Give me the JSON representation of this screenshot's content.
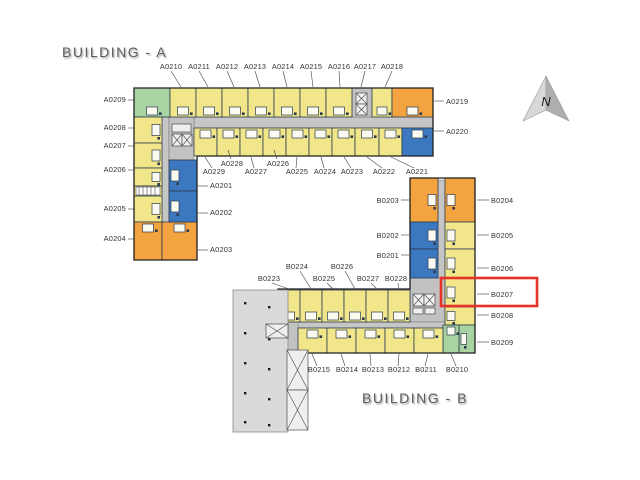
{
  "titles": {
    "building_a": "BUILDING - A",
    "building_b": "BUILDING - B"
  },
  "compass": {
    "label": "N"
  },
  "colors": {
    "yellow": "#f1e78a",
    "orange": "#f3a440",
    "blue": "#3c78c0",
    "green": "#a7d4a2",
    "corridor": "#c6c6c6",
    "core": "#c2c2c2",
    "podium": "#dadada",
    "highlight": "#e53427",
    "line": "#2c3a4e"
  },
  "highlight": {
    "unit": "B0207"
  },
  "building_a": {
    "top_labels": [
      "A0210",
      "A0211",
      "A0212",
      "A0213",
      "A0214",
      "A0215",
      "A0216",
      "A0217",
      "A0218"
    ],
    "left_labels": [
      "A0209",
      "A0208",
      "A0207",
      "A0206",
      "A0205",
      "A0204"
    ],
    "right_end_labels": [
      "A0219",
      "A0220"
    ],
    "inner_labels": [
      "A0201",
      "A0202",
      "A0203"
    ],
    "bottom_upper_labels": [
      "A0228",
      "A0226"
    ],
    "bottom_lower_labels": [
      "A0229",
      "A0227",
      "A0225",
      "A0224",
      "A0223",
      "A0222",
      "A0221"
    ]
  },
  "building_b": {
    "left_labels": [
      "B0203",
      "B0202",
      "B0201"
    ],
    "right_labels": [
      "B0204",
      "B0205",
      "B0206",
      "B0207",
      "B0208",
      "B0209"
    ],
    "top_upper_labels": [
      "B0224",
      "B0226"
    ],
    "top_lower_labels": [
      "B0223",
      "B0225",
      "B0227",
      "B0228"
    ],
    "bottom_labels": [
      "B0215",
      "B0214",
      "B0213",
      "B0212",
      "B0211",
      "B0210"
    ]
  }
}
